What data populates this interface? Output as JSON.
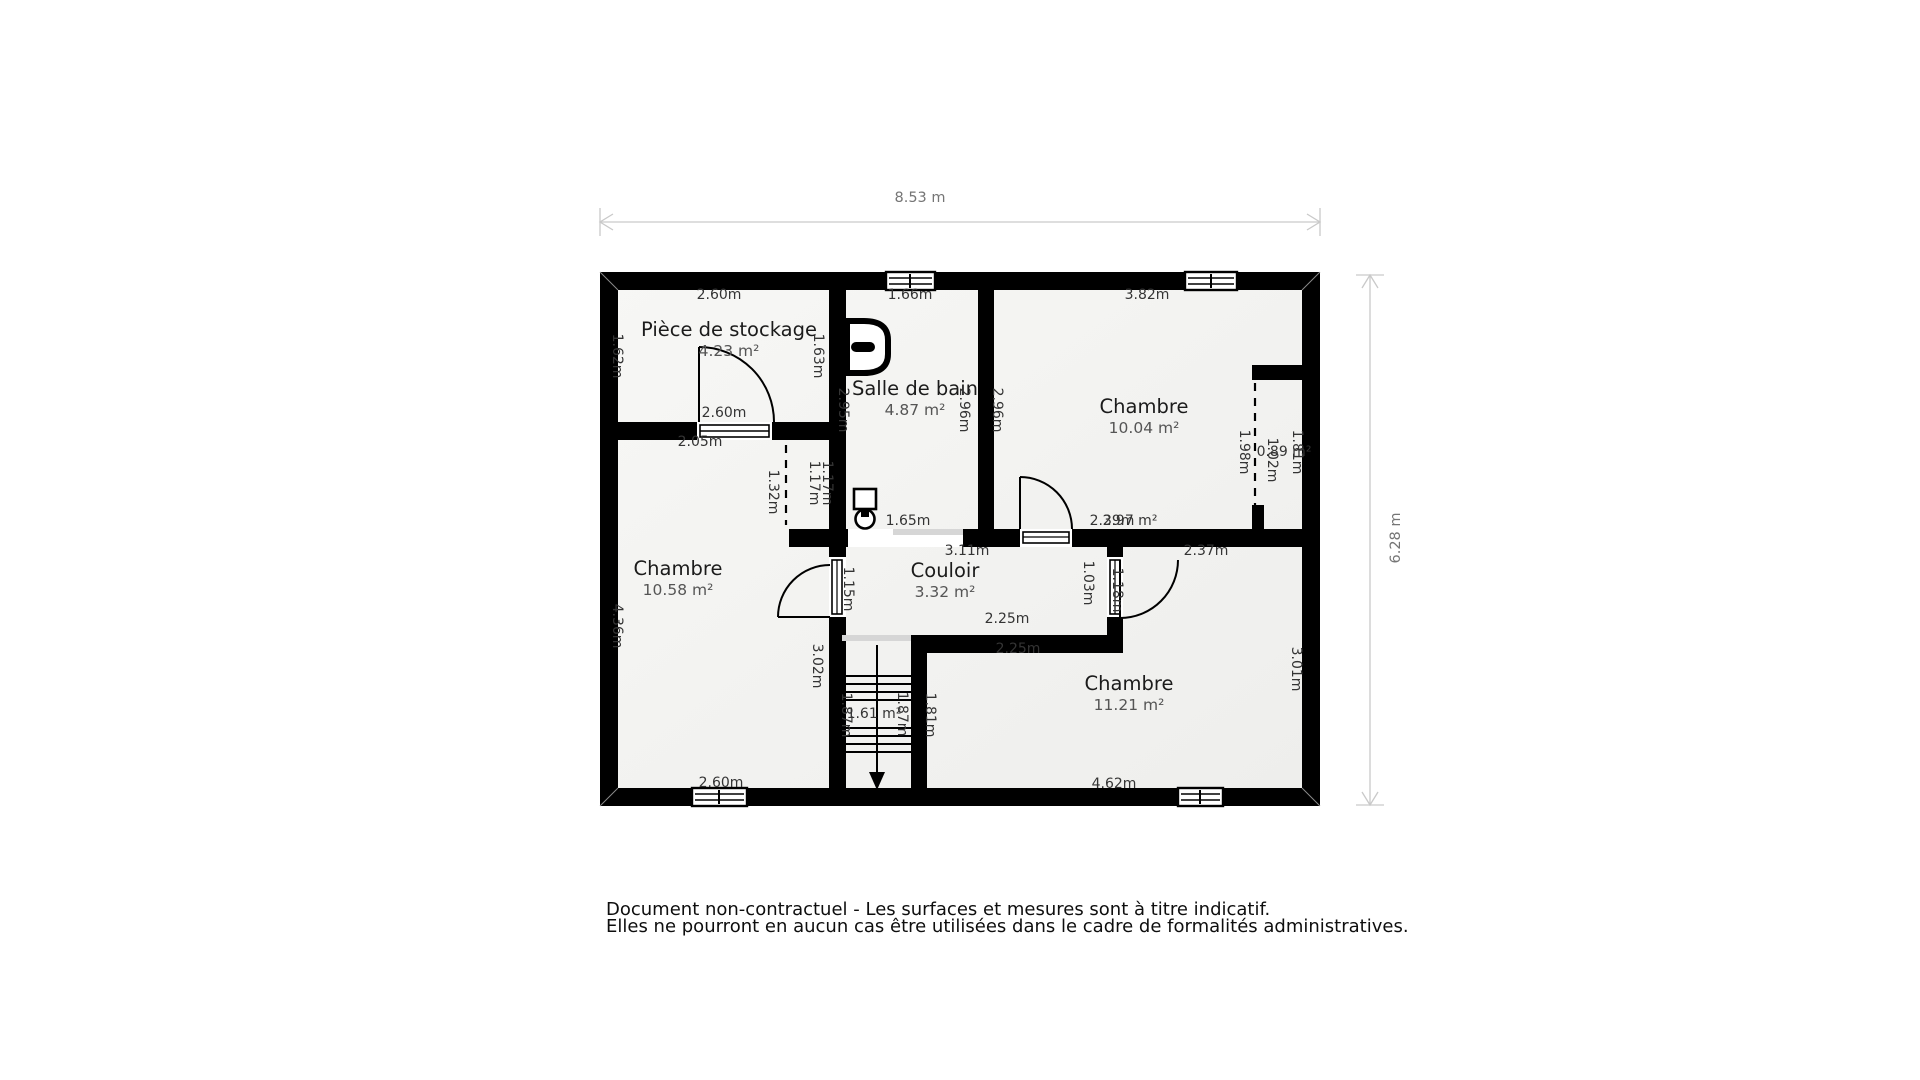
{
  "overall": {
    "width_label": "8.53 m",
    "height_label": "6.28 m"
  },
  "rooms": [
    {
      "name": "Pièce de stockage",
      "area": "4.23 m²",
      "x": 729,
      "y": 340
    },
    {
      "name": "Salle de bain",
      "area": "4.87 m²",
      "x": 915,
      "y": 399
    },
    {
      "name": "Chambre",
      "area": "10.04 m²",
      "x": 1144,
      "y": 417
    },
    {
      "name": "Chambre",
      "area": "10.58 m²",
      "x": 678,
      "y": 579
    },
    {
      "name": "Couloir",
      "area": "3.32 m²",
      "x": 945,
      "y": 581
    },
    {
      "name": "Chambre",
      "area": "11.21 m²",
      "x": 1129,
      "y": 694
    }
  ],
  "dim_labels": [
    {
      "t": "2.60m",
      "x": 719,
      "y": 295
    },
    {
      "t": "1.66m",
      "x": 910,
      "y": 295
    },
    {
      "t": "3.82m",
      "x": 1147,
      "y": 295
    },
    {
      "t": "1.62m",
      "x": 617,
      "y": 356,
      "r": 90
    },
    {
      "t": "1.63m",
      "x": 818,
      "y": 356,
      "r": 90
    },
    {
      "t": "2.95m",
      "x": 843,
      "y": 410,
      "r": 90
    },
    {
      "t": "2.96m",
      "x": 964,
      "y": 410,
      "r": 90
    },
    {
      "t": "2.96m",
      "x": 997,
      "y": 410,
      "r": 90
    },
    {
      "t": "2.60m",
      "x": 724,
      "y": 413
    },
    {
      "t": "2.05m",
      "x": 700,
      "y": 442
    },
    {
      "t": "1.32m",
      "x": 773,
      "y": 492,
      "r": 90
    },
    {
      "t": "1.17m",
      "x": 814,
      "y": 483,
      "r": 90
    },
    {
      "t": "1.17m",
      "x": 827,
      "y": 483,
      "r": 90
    },
    {
      "t": "1.65m",
      "x": 908,
      "y": 521
    },
    {
      "t": "3.11m",
      "x": 967,
      "y": 551
    },
    {
      "t": "2.39m",
      "x": 1112,
      "y": 521
    },
    {
      "t": "2.97 m²",
      "x": 1130,
      "y": 521
    },
    {
      "t": "2.37m",
      "x": 1206,
      "y": 551
    },
    {
      "t": "1.98m",
      "x": 1244,
      "y": 452,
      "r": 90
    },
    {
      "t": "1.02m",
      "x": 1272,
      "y": 460,
      "r": 90
    },
    {
      "t": "0.89 m²",
      "x": 1284,
      "y": 452
    },
    {
      "t": "1.81m",
      "x": 1297,
      "y": 452,
      "r": 90
    },
    {
      "t": "1.15m",
      "x": 848,
      "y": 589,
      "r": 90
    },
    {
      "t": "1.03m",
      "x": 1088,
      "y": 583,
      "r": 90
    },
    {
      "t": "1.18m",
      "x": 1117,
      "y": 590,
      "r": 90
    },
    {
      "t": "2.25m",
      "x": 1007,
      "y": 619
    },
    {
      "t": "2.25m",
      "x": 1018,
      "y": 649
    },
    {
      "t": "3.02m",
      "x": 817,
      "y": 666,
      "r": 90
    },
    {
      "t": "1.87m",
      "x": 846,
      "y": 715,
      "r": 90
    },
    {
      "t": "1.61 m²",
      "x": 874,
      "y": 714
    },
    {
      "t": "1.87m",
      "x": 902,
      "y": 714,
      "r": 90
    },
    {
      "t": "1.81m",
      "x": 930,
      "y": 715,
      "r": 90
    },
    {
      "t": "3.01m",
      "x": 1296,
      "y": 669,
      "r": 90
    },
    {
      "t": "4.36m",
      "x": 617,
      "y": 626,
      "r": 90
    },
    {
      "t": "2.60m",
      "x": 721,
      "y": 783
    },
    {
      "t": "4.62m",
      "x": 1114,
      "y": 784
    }
  ],
  "overall_labels": [
    {
      "t": "8.53 m",
      "x": 920,
      "y": 198,
      "muted": true
    },
    {
      "t": "6.28 m",
      "x": 1396,
      "y": 538,
      "r": -90,
      "muted": true
    }
  ],
  "fixtures": [
    {
      "icon": "toilet-icon"
    },
    {
      "icon": "sink-icon"
    },
    {
      "icon": "stairs-down-icon"
    }
  ],
  "colors": {
    "wall": "#000000",
    "room_fill": "#f3f3f1",
    "opening_gray": "#d6d6d6",
    "dimension_line": "#c9c9c9"
  },
  "footer": {
    "line1": "Document non-contractuel - Les surfaces et mesures sont à titre indicatif.",
    "line2": "Elles ne pourront en aucun cas être utilisées dans le cadre de formalités administratives."
  }
}
